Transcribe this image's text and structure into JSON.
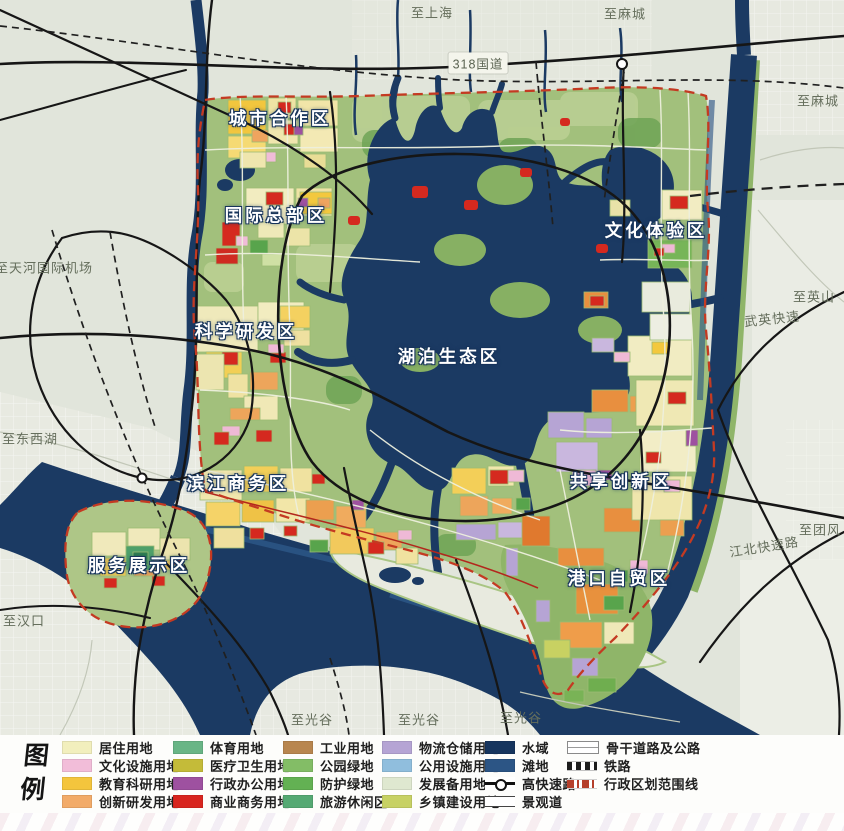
{
  "map": {
    "district_labels": [
      {
        "id": "chengshi-hezuo",
        "text": "城市合作区",
        "x": 280,
        "y": 118
      },
      {
        "id": "guoji-zongbu",
        "text": "国际总部区",
        "x": 276,
        "y": 215
      },
      {
        "id": "wenhua-tiyan",
        "text": "文化体验区",
        "x": 656,
        "y": 230
      },
      {
        "id": "kexue-yanfa",
        "text": "科学研发区",
        "x": 246,
        "y": 331
      },
      {
        "id": "hupo-shengtai",
        "text": "湖泊生态区",
        "x": 449,
        "y": 356
      },
      {
        "id": "binjiang-shangwu",
        "text": "滨江商务区",
        "x": 238,
        "y": 483
      },
      {
        "id": "gongxiang-chuangxin",
        "text": "共享创新区",
        "x": 621,
        "y": 481
      },
      {
        "id": "fuwu-zhanshi",
        "text": "服务展示区",
        "x": 139,
        "y": 565
      },
      {
        "id": "gangkou-zimao",
        "text": "港口自贸区",
        "x": 619,
        "y": 578
      }
    ],
    "edge_labels": [
      {
        "text": "至上海",
        "x": 432,
        "y": 12
      },
      {
        "text": "至麻城",
        "x": 625,
        "y": 13
      },
      {
        "text": "318国道",
        "x": 478,
        "y": 63,
        "badge": true
      },
      {
        "text": "至麻城",
        "x": 818,
        "y": 100
      },
      {
        "text": "至英山",
        "x": 814,
        "y": 296
      },
      {
        "text": "武英快速",
        "x": 772,
        "y": 318,
        "rotate": -6
      },
      {
        "text": "至团风",
        "x": 820,
        "y": 529
      },
      {
        "text": "江北快速路",
        "x": 764,
        "y": 546,
        "rotate": -9
      },
      {
        "text": "至天河国际机场",
        "x": 44,
        "y": 267
      },
      {
        "text": "至东西湖",
        "x": 30,
        "y": 438
      },
      {
        "text": "至汉口",
        "x": 24,
        "y": 620
      },
      {
        "text": "至光谷",
        "x": 312,
        "y": 719
      },
      {
        "text": "至光谷",
        "x": 419,
        "y": 719
      },
      {
        "text": "至光谷",
        "x": 521,
        "y": 717
      }
    ]
  },
  "legend": {
    "title_top": "图",
    "title_bottom": "例",
    "columns": [
      {
        "items": [
          {
            "label": "居住用地",
            "type": "fill",
            "color": "#f2efbd"
          },
          {
            "label": "文化设施用地",
            "type": "fill",
            "color": "#f2bdd9"
          },
          {
            "label": "教育科研用地",
            "type": "fill",
            "color": "#f4c53d"
          },
          {
            "label": "创新研发用地",
            "type": "fill",
            "color": "#f2ab69"
          }
        ]
      },
      {
        "items": [
          {
            "label": "体育用地",
            "type": "fill",
            "color": "#69b586"
          },
          {
            "label": "医疗卫生用地",
            "type": "fill",
            "color": "#c4bb39"
          },
          {
            "label": "行政办公用地",
            "type": "fill",
            "color": "#9e51a0"
          },
          {
            "label": "商业商务用地",
            "type": "fill",
            "color": "#d8251f"
          }
        ]
      },
      {
        "items": [
          {
            "label": "工业用地",
            "type": "fill",
            "color": "#b8864f"
          },
          {
            "label": "公园绿地",
            "type": "fill",
            "color": "#83bd66"
          },
          {
            "label": "防护绿地",
            "type": "fill",
            "color": "#63b153"
          },
          {
            "label": "旅游休闲区",
            "type": "fill",
            "color": "#55a973"
          }
        ]
      },
      {
        "items": [
          {
            "label": "物流仓储用地",
            "type": "fill",
            "color": "#b5a4d4"
          },
          {
            "label": "公用设施用地",
            "type": "fill",
            "color": "#90bedd"
          },
          {
            "label": "发展备用地",
            "type": "fill",
            "color": "#dfe8d0"
          },
          {
            "label": "乡镇建设用地",
            "type": "fill",
            "color": "#c7d164"
          }
        ]
      },
      {
        "items": [
          {
            "label": "水域",
            "type": "fill",
            "color": "#16355e"
          },
          {
            "label": "滩地",
            "type": "fill",
            "color": "#2c5585"
          },
          {
            "label": "高快速路",
            "type": "expressway"
          },
          {
            "label": "景观道",
            "type": "scenic"
          }
        ]
      },
      {
        "items": [
          {
            "label": "骨干道路及公路",
            "type": "trunk"
          },
          {
            "label": "铁路",
            "type": "railway"
          },
          {
            "label": "行政区划范围线",
            "type": "boundary"
          }
        ]
      }
    ]
  }
}
